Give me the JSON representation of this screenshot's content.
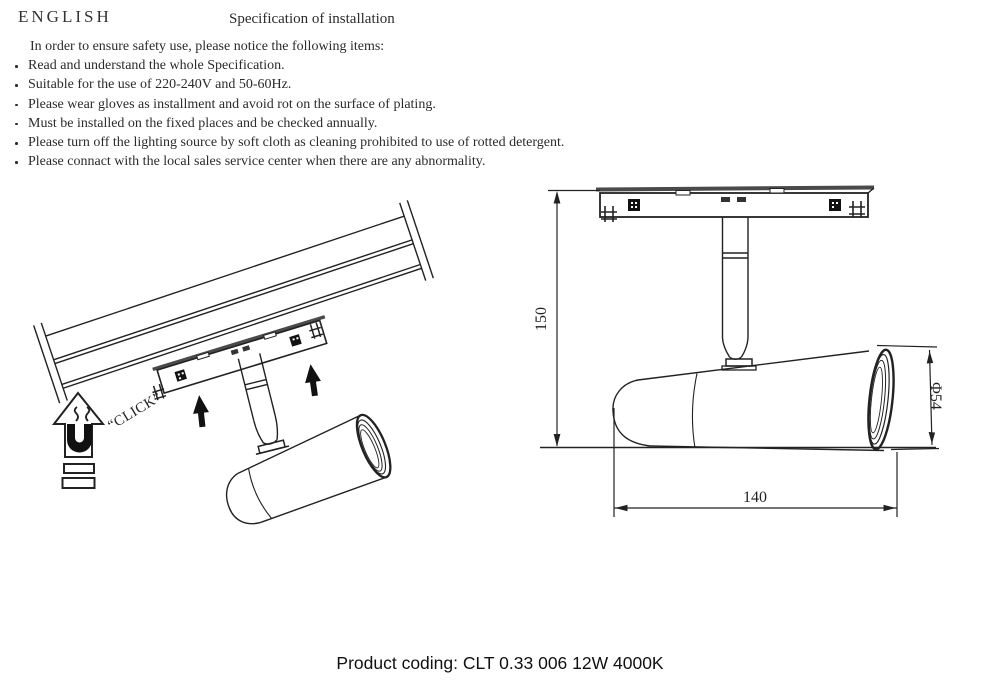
{
  "header": {
    "language_label": "ENGLISH",
    "title": "Specification of installation"
  },
  "safety_notice": {
    "intro": "In order to ensure safety use, please notice the following items:",
    "items": [
      "Read and understand the whole Specification.",
      "Suitable for the use of 220-240V and 50-60Hz.",
      "Please wear gloves as installment and avoid rot on the surface of plating.",
      "Must be installed on the fixed places and be checked annually.",
      "Please turn off the lighting source by soft cloth as cleaning prohibited to use of rotted detergent.",
      "Please connact with the local sales service center when there are any abnormality."
    ]
  },
  "installation_diagram": {
    "click_label": "“CLICK”"
  },
  "dimension_diagram": {
    "height": "150",
    "length": "140",
    "diameter": "Φ54"
  },
  "footer": {
    "product_coding": "Product coding: CLT 0.33 006 12W 4000K"
  },
  "colors": {
    "line": "#222222",
    "background": "#ffffff"
  }
}
